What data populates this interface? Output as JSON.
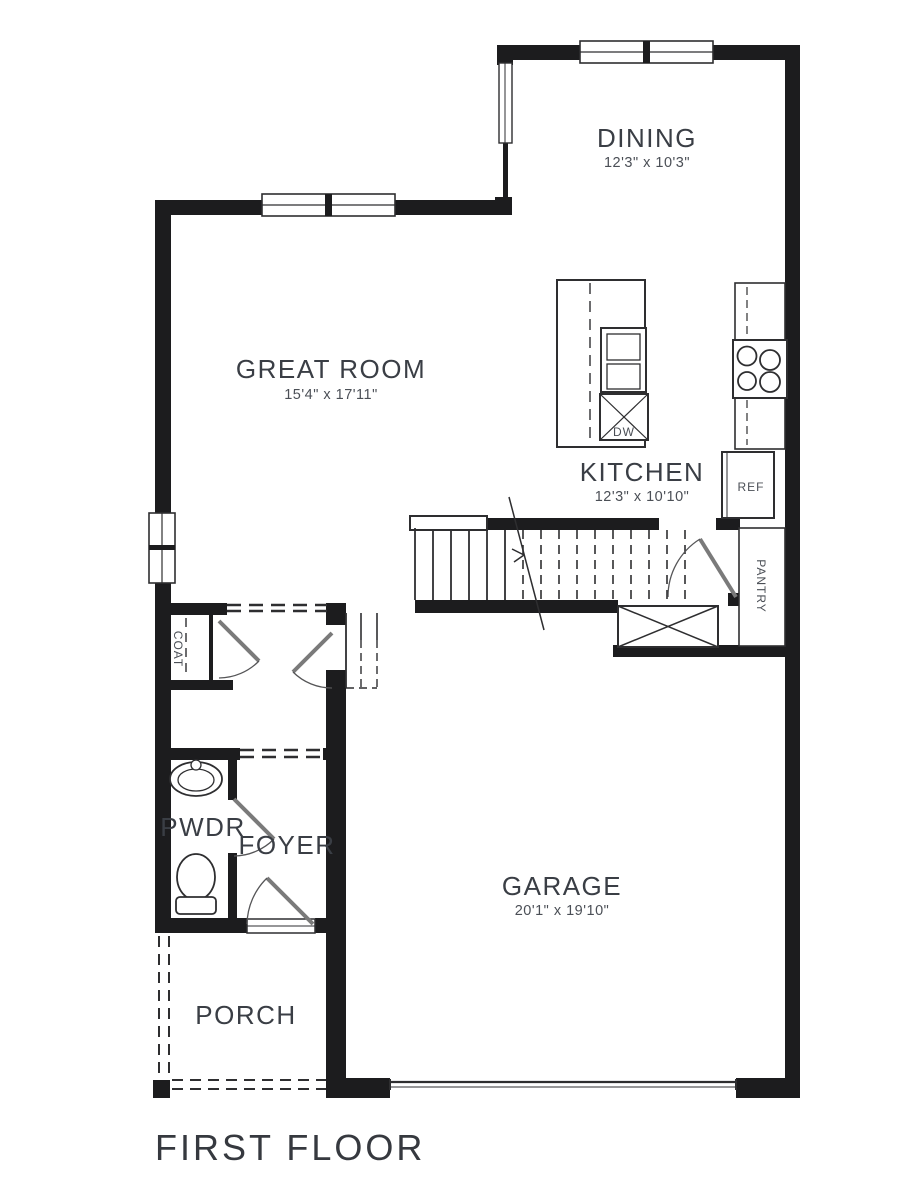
{
  "title": "FIRST FLOOR",
  "rooms": {
    "dining": {
      "name": "DINING",
      "dims": "12'3\" x 10'3\""
    },
    "great_room": {
      "name": "GREAT ROOM",
      "dims": "15'4\" x 17'11\""
    },
    "kitchen": {
      "name": "KITCHEN",
      "dims": "12'3\" x 10'10\""
    },
    "garage": {
      "name": "GARAGE",
      "dims": "20'1\" x 19'10\""
    },
    "pwdr": {
      "name": "PWDR"
    },
    "foyer": {
      "name": "FOYER"
    },
    "porch": {
      "name": "PORCH"
    },
    "coat": {
      "name": "COAT"
    },
    "pantry": {
      "name": "PANTRY"
    }
  },
  "fixtures": {
    "dishwasher": "DW",
    "refrigerator": "REF"
  },
  "colors": {
    "wall": "#1c1c1e",
    "line": "#2e2e30",
    "label": "#3a3e45",
    "dims": "#4b4f56"
  }
}
